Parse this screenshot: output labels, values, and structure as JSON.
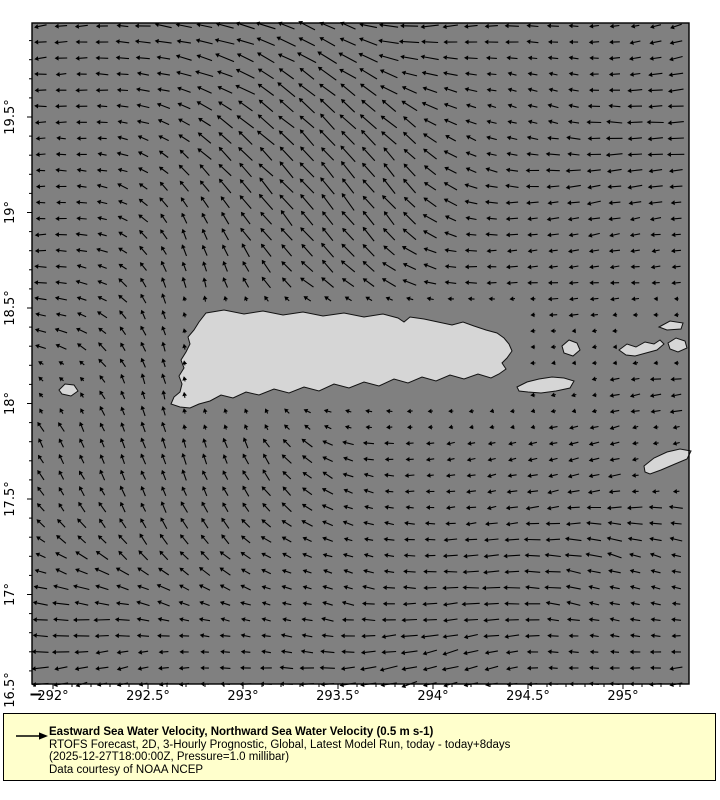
{
  "legend": {
    "title": "Eastward Sea Water Velocity, Northward Sea Water Velocity (0.5 m s-1)",
    "line_forecast": "RTOFS Forecast, 2D, 3-Hourly Prognostic, Global, Latest Model Run, today - today+8days",
    "line_time": "(2025-12-27T18:00:00Z, Pressure=1.0 millibar)",
    "line_credit": "Data courtesy of NOAA NCEP",
    "reference_vector": "0.5 m s-1",
    "background_color": "#ffffcc"
  },
  "chart_data": {
    "type": "quiver",
    "title": "Eastward Sea Water Velocity, Northward Sea Water Velocity (0.5 m s-1)",
    "subtitle": "RTOFS Forecast, 2D, 3-Hourly Prognostic, Global, Latest Model Run, today - today+8days",
    "time_note": "(2025-12-27T18:00:00Z, Pressure=1.0 millibar)",
    "credit": "Data courtesy of NOAA NCEP",
    "reference_vector": "0.5 m s-1",
    "xlabel": "longitude (degrees east)",
    "ylabel": "latitude (degrees north)",
    "x_range": [
      291.89,
      295.35
    ],
    "y_range": [
      16.53,
      19.99
    ],
    "x_ticks": {
      "values": [
        292,
        292.5,
        293,
        293.5,
        294,
        294.5,
        295
      ],
      "labels": [
        "292°",
        "292.5°",
        "293°",
        "293.5°",
        "294°",
        "294.5°",
        "295°"
      ]
    },
    "y_ticks": {
      "values": [
        19.5,
        19,
        18.5,
        18,
        17.5,
        17,
        16.5
      ],
      "labels": [
        "19.5°",
        "19°",
        "18.5°",
        "18°",
        "17.5°",
        "17°",
        "16.5°"
      ]
    },
    "minor_tick_step": 0.1,
    "colors": {
      "ocean": "#808080",
      "land": "#d6d6d6",
      "coast": "#111111",
      "arrows": "#000000",
      "axis": "#000000",
      "legend_bg": "#ffffcc"
    },
    "projection": {
      "lon_ref": 292,
      "lon_ref_x": 53,
      "px_per_lon": 190,
      "lat_ref": 16.5,
      "lat_ref_y": 690,
      "px_per_lat": 191,
      "plot": {
        "left": 32,
        "top": 23,
        "width": 657,
        "height": 661
      }
    },
    "flow_field": {
      "description": "Broad westward North Equatorial current over most of the domain; strong northwestward jet curving west in the upper-left; northward flow through Mona Passage west of Puerto Rico; weak flow in the island lee; slight southwest tilt east of the island.",
      "grid": {
        "x0": 41,
        "dx": 20.5,
        "cols": 32,
        "y0": 26,
        "dy": 16.05,
        "rows": 42
      },
      "base": {
        "angle": 180,
        "len": 13,
        "weight": 0.4,
        "a1": 9,
        "f1x": 0.02,
        "f1y": 0.008,
        "ph1": 0,
        "a2": 7,
        "f2y": 0.028,
        "ph2": 1.3,
        "lenAmp": 3.5,
        "lenFx": 0.016,
        "lenFy": 0.02,
        "lenPh": 0.7
      },
      "noise": {
        "angle_deg": 10,
        "len_frac": 0.25
      },
      "regions": [
        [
          175,
          330,
          55,
          120,
          90,
          10,
          2.2,
          "mona-passage-northward"
        ],
        [
          120,
          440,
          95,
          45,
          100,
          10,
          1.6,
          "southwest-turn-north"
        ],
        [
          140,
          480,
          110,
          35,
          120,
          12,
          1.2,
          "southwest-turn-nw"
        ],
        [
          345,
          205,
          55,
          55,
          115,
          20,
          2.2,
          "jet-lower-nnw"
        ],
        [
          285,
          120,
          60,
          65,
          135,
          22,
          2.6,
          "jet-mid-nw"
        ],
        [
          222,
          48,
          55,
          40,
          168,
          20,
          2.2,
          "jet-top-west"
        ],
        [
          120,
          85,
          70,
          60,
          182,
          11,
          1.5,
          "northwest-corner-west"
        ],
        [
          95,
          250,
          45,
          90,
          182,
          10,
          1.5,
          "west-edge-westward"
        ],
        [
          560,
          295,
          110,
          55,
          184,
          8,
          1.2,
          "east-of-island-slow-west"
        ],
        [
          600,
          415,
          85,
          45,
          198,
          9,
          1.0,
          "east-southwest-tilt"
        ],
        [
          480,
          440,
          80,
          40,
          188,
          7,
          0.8,
          "south-lee-weak"
        ]
      ],
      "land_masks": [
        [
          186,
          309,
          514,
          408
        ],
        [
          514,
          374,
          580,
          395
        ],
        [
          558,
          337,
          584,
          359
        ],
        [
          615,
          330,
          700,
          358
        ],
        [
          656,
          316,
          700,
          332
        ],
        [
          641,
          445,
          696,
          477
        ],
        [
          54,
          380,
          82,
          398
        ]
      ]
    },
    "landmasses": [
      {
        "name": "puerto-rico",
        "points": [
          [
            206,
            313
          ],
          [
            224,
            310
          ],
          [
            244,
            314
          ],
          [
            263,
            311
          ],
          [
            283,
            315
          ],
          [
            303,
            312
          ],
          [
            323,
            316
          ],
          [
            344,
            313
          ],
          [
            364,
            317
          ],
          [
            383,
            314
          ],
          [
            398,
            318
          ],
          [
            404,
            322
          ],
          [
            410,
            317
          ],
          [
            424,
            319
          ],
          [
            438,
            322
          ],
          [
            452,
            325
          ],
          [
            463,
            322
          ],
          [
            474,
            326
          ],
          [
            486,
            330
          ],
          [
            497,
            333
          ],
          [
            504,
            338
          ],
          [
            509,
            344
          ],
          [
            512,
            351
          ],
          [
            507,
            358
          ],
          [
            502,
            363
          ],
          [
            506,
            369
          ],
          [
            499,
            374
          ],
          [
            491,
            378
          ],
          [
            478,
            374
          ],
          [
            464,
            379
          ],
          [
            450,
            375
          ],
          [
            436,
            381
          ],
          [
            422,
            377
          ],
          [
            408,
            383
          ],
          [
            394,
            379
          ],
          [
            379,
            386
          ],
          [
            364,
            382
          ],
          [
            349,
            388
          ],
          [
            334,
            384
          ],
          [
            319,
            391
          ],
          [
            304,
            387
          ],
          [
            289,
            393
          ],
          [
            274,
            389
          ],
          [
            259,
            395
          ],
          [
            246,
            392
          ],
          [
            233,
            398
          ],
          [
            221,
            395
          ],
          [
            210,
            401
          ],
          [
            199,
            404
          ],
          [
            190,
            408
          ],
          [
            180,
            407
          ],
          [
            171,
            404
          ],
          [
            174,
            397
          ],
          [
            180,
            392
          ],
          [
            182,
            384
          ],
          [
            179,
            376
          ],
          [
            184,
            368
          ],
          [
            181,
            360
          ],
          [
            186,
            352
          ],
          [
            190,
            344
          ],
          [
            188,
            337
          ],
          [
            194,
            330
          ],
          [
            199,
            322
          ]
        ]
      },
      {
        "name": "vieques",
        "points": [
          [
            517,
            387
          ],
          [
            527,
            382
          ],
          [
            539,
            379
          ],
          [
            552,
            377
          ],
          [
            564,
            378
          ],
          [
            574,
            381
          ],
          [
            570,
            388
          ],
          [
            556,
            391
          ],
          [
            541,
            393
          ],
          [
            528,
            392
          ],
          [
            519,
            391
          ]
        ]
      },
      {
        "name": "culebra",
        "points": [
          [
            562,
            346
          ],
          [
            569,
            340
          ],
          [
            577,
            343
          ],
          [
            580,
            350
          ],
          [
            573,
            356
          ],
          [
            564,
            353
          ]
        ]
      },
      {
        "name": "st-thomas-st-john",
        "points": [
          [
            619,
            350
          ],
          [
            627,
            344
          ],
          [
            636,
            347
          ],
          [
            645,
            342
          ],
          [
            654,
            344
          ],
          [
            660,
            340
          ],
          [
            664,
            344
          ],
          [
            657,
            350
          ],
          [
            646,
            353
          ],
          [
            635,
            356
          ],
          [
            626,
            355
          ]
        ]
      },
      {
        "name": "virgin-gorda",
        "points": [
          [
            668,
            343
          ],
          [
            676,
            338
          ],
          [
            685,
            341
          ],
          [
            687,
            348
          ],
          [
            678,
            352
          ],
          [
            670,
            349
          ]
        ]
      },
      {
        "name": "tortola",
        "points": [
          [
            659,
            327
          ],
          [
            670,
            321
          ],
          [
            683,
            323
          ],
          [
            681,
            329
          ],
          [
            667,
            330
          ]
        ]
      },
      {
        "name": "st-croix",
        "points": [
          [
            644,
            466
          ],
          [
            654,
            458
          ],
          [
            667,
            452
          ],
          [
            680,
            449
          ],
          [
            691,
            451
          ],
          [
            687,
            459
          ],
          [
            675,
            464
          ],
          [
            661,
            470
          ],
          [
            650,
            474
          ],
          [
            645,
            472
          ]
        ]
      },
      {
        "name": "mona",
        "points": [
          [
            59,
            390
          ],
          [
            65,
            384
          ],
          [
            74,
            385
          ],
          [
            78,
            391
          ],
          [
            71,
            396
          ],
          [
            62,
            394
          ]
        ]
      }
    ]
  }
}
